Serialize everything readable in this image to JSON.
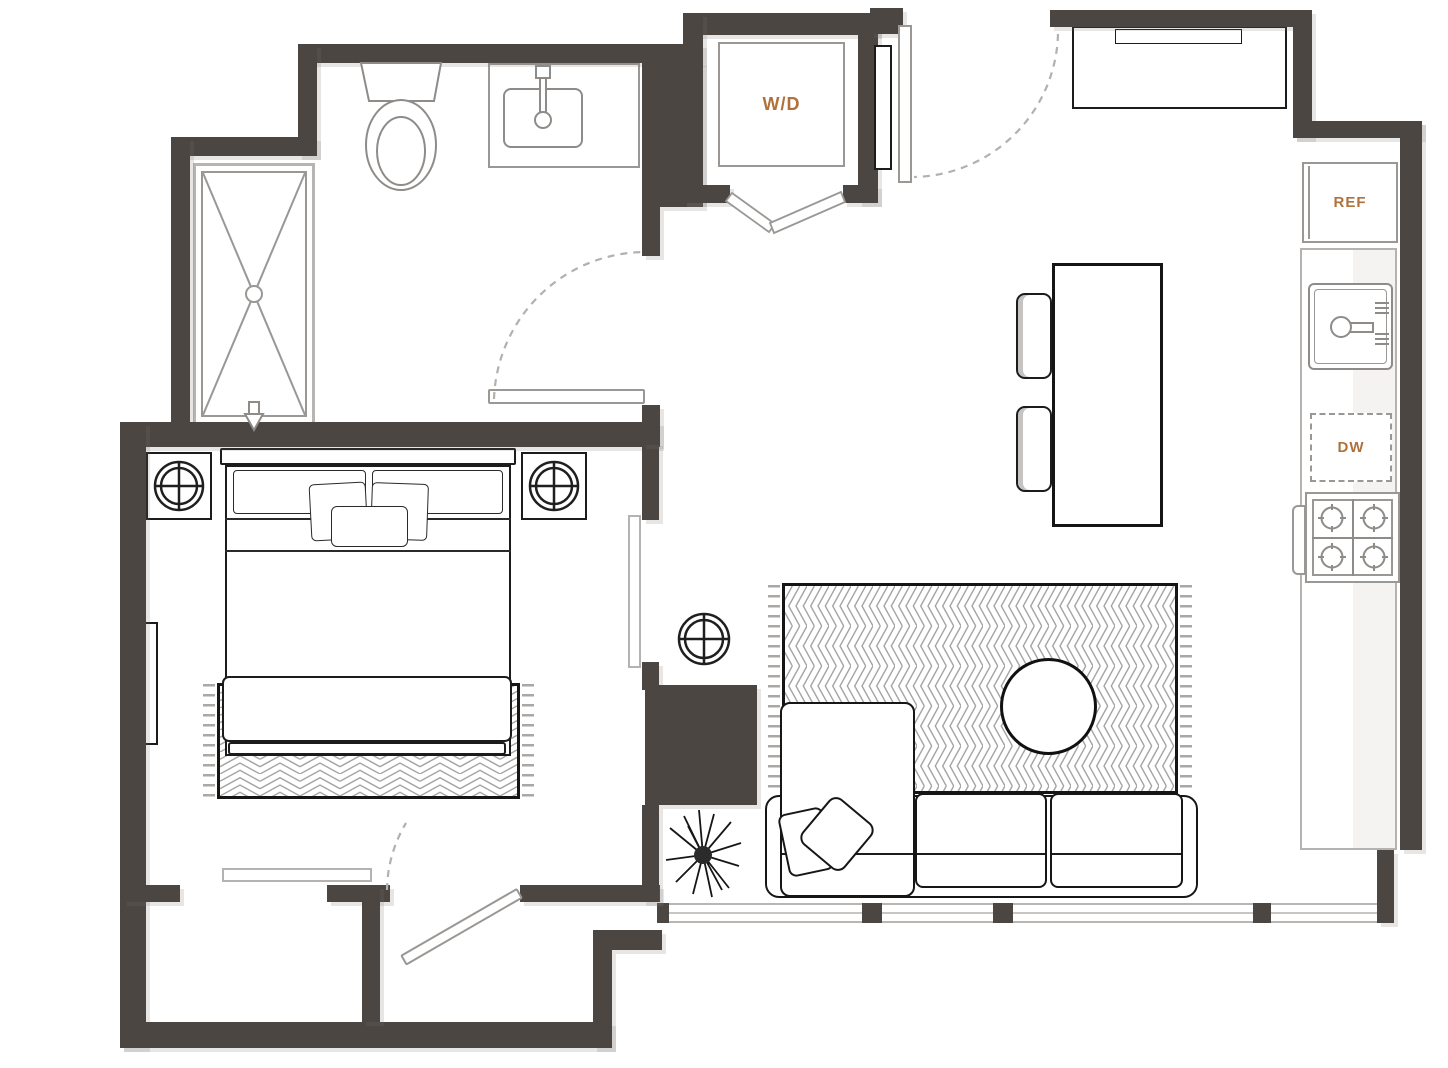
{
  "plan": {
    "labels": {
      "washer_dryer": "W/D",
      "refrigerator": "REF",
      "dishwasher": "DW"
    },
    "colors": {
      "wall": "#4b4642",
      "floor": "#ffffff",
      "fixture_line": "#9a9794",
      "furniture_line": "#1c1c1c",
      "pattern_line": "#a6a4a2",
      "label_accent": "#b0713a"
    },
    "fixtures": [
      "shower",
      "toilet",
      "bathroom-sink",
      "washer-dryer",
      "entry-door",
      "console-table",
      "refrigerator",
      "kitchen-sink",
      "dishwasher",
      "stove",
      "kitchen-island",
      "stools",
      "bed",
      "nightstands",
      "lamps",
      "rugs",
      "sectional-sofa",
      "coffee-table",
      "plant",
      "closet-sliding-doors",
      "window-wall"
    ]
  }
}
